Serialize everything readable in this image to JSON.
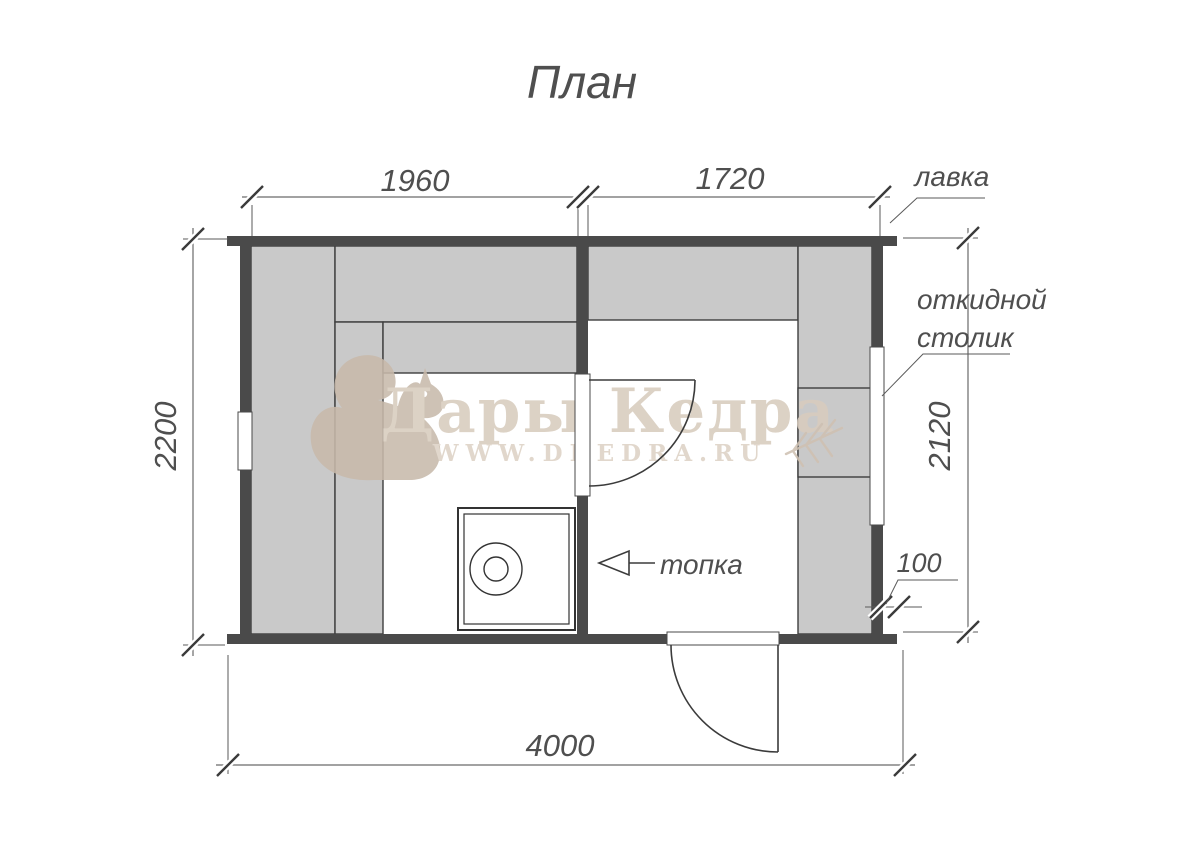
{
  "title": "План",
  "watermark": {
    "brand": "Дары Кедра",
    "site": "WWW.DKEDRA.RU"
  },
  "dimensions": {
    "steam_room_width": "1960",
    "wash_room_width": "1720",
    "building_depth": "2200",
    "right_interior_depth": "2120",
    "wall_thickness": "100",
    "building_width": "4000"
  },
  "labels": {
    "bench": "лавка",
    "folding_table_line1": "откидной",
    "folding_table_line2": "столик",
    "firebox": "топка"
  },
  "colors": {
    "wall": "#4a4a4a",
    "bench_fill": "#c9c9c9",
    "dimension_line": "#5a5a5a",
    "watermark_beige": "#d6cabb"
  }
}
